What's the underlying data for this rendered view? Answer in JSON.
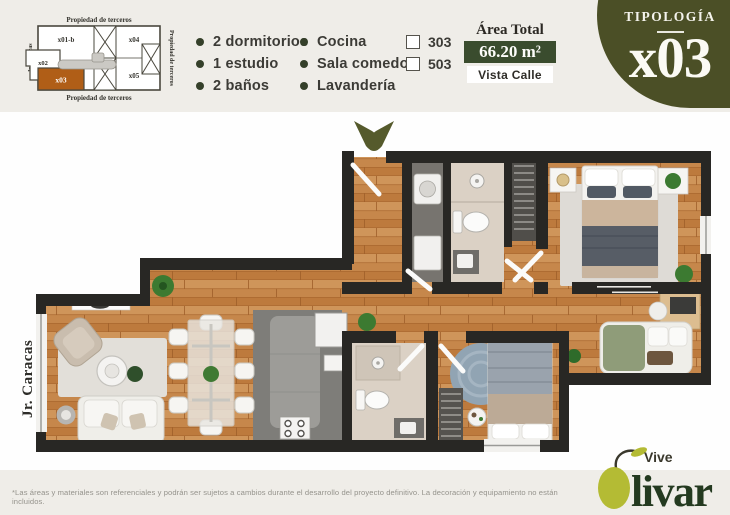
{
  "page": {
    "disclaimer": "*Las áreas y materiales son referenciales y podrán ser sujetos a cambios durante el desarrollo del proyecto definitivo. La decoración y equipamiento no están incluidos."
  },
  "keyplan": {
    "label_top": "Propiedad de terceros",
    "label_bottom": "Propiedad de terceros",
    "label_right": "Propiedad de terceros",
    "label_left": "Jr. Caracas",
    "units": {
      "u1": "x01-b",
      "u2": "x02",
      "u3": "x03",
      "u4": "x04",
      "u5": "x05"
    },
    "highlighted_unit": "x03"
  },
  "features": {
    "col1": [
      "2 dormitorios",
      "1 estudio",
      "2 baños"
    ],
    "col2": [
      "Cocina",
      "Sala comedor",
      "Lavandería"
    ]
  },
  "floors": [
    "303",
    "503"
  ],
  "area": {
    "label": "Área Total",
    "value": "66.20 m²",
    "view": "Vista Calle"
  },
  "typology": {
    "label": "TIPOLOGÍA",
    "code": "x03"
  },
  "plan": {
    "street": "Jr. Caracas"
  },
  "logo": {
    "tagline": "Vive",
    "name_rest": "livar"
  },
  "colors": {
    "background": "#efede8",
    "accent_olive": "#4b4f26",
    "badge_green": "#3a4c2e",
    "highlight_orange": "#b05e17",
    "wall": "#282724",
    "wood": "#c6874b",
    "logo_lime": "#b4bb34",
    "logo_green": "#243a20"
  }
}
